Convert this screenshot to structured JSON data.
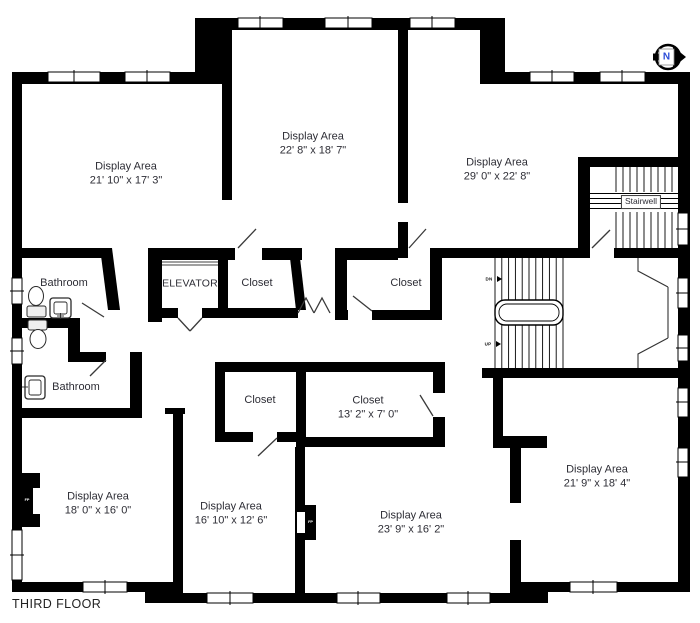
{
  "title": "THIRD FLOOR",
  "north_indicator": "N",
  "colors": {
    "wall": "#000000",
    "text": "#2d2d35",
    "north_n": "#2a4bd7"
  },
  "rooms": [
    {
      "id": "display-top-left",
      "name": "Display Area",
      "dims": "21' 10\" x 17' 3\""
    },
    {
      "id": "display-top-middle",
      "name": "Display Area",
      "dims": "22' 8\" x 18' 7\""
    },
    {
      "id": "display-top-right",
      "name": "Display Area",
      "dims": "29' 0\" x 22' 8\""
    },
    {
      "id": "stairwell",
      "name": "Stairwell"
    },
    {
      "id": "bathroom-upper",
      "name": "Bathroom"
    },
    {
      "id": "elevator",
      "name": "ELEVATOR"
    },
    {
      "id": "closet-by-elevator",
      "name": "Closet"
    },
    {
      "id": "closet-middle",
      "name": "Closet"
    },
    {
      "id": "bathroom-lower",
      "name": "Bathroom"
    },
    {
      "id": "closet-lower-left",
      "name": "Closet"
    },
    {
      "id": "closet-lower-right",
      "name": "Closet",
      "dims": "13' 2\" x 7' 0\""
    },
    {
      "id": "display-bottom-left",
      "name": "Display Area",
      "dims": "18' 0\" x 16' 0\""
    },
    {
      "id": "display-bottom-mid",
      "name": "Display Area",
      "dims": "16' 10\" x 12' 6\""
    },
    {
      "id": "display-bottom-ctr",
      "name": "Display Area",
      "dims": "23' 9\" x 16' 2\""
    },
    {
      "id": "display-right",
      "name": "Display Area",
      "dims": "21' 9\" x 18' 4\""
    }
  ],
  "stairs": {
    "down_label": "DN",
    "up_label": "UP"
  },
  "fireplace_label": "FP"
}
